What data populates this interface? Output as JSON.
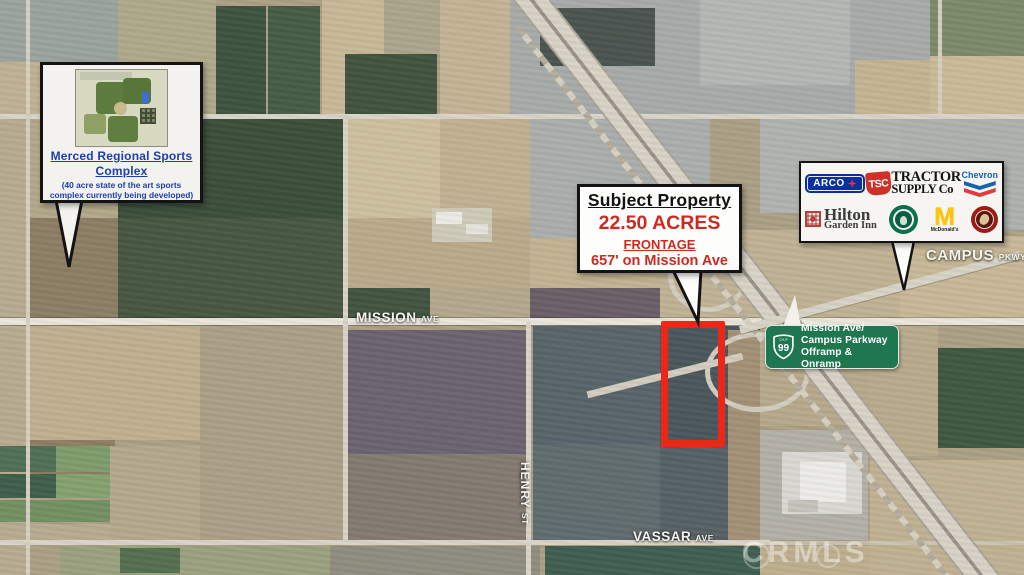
{
  "streets": {
    "mission_name": "MISSION",
    "mission_type": "AVE",
    "campus_name": "CAMPUS",
    "campus_type": "PKWY",
    "henry_name": "HENRY",
    "henry_type": "ST",
    "vassar_name": "VASSAR",
    "vassar_type": "AVE"
  },
  "watermark": "CRMLS",
  "sports_callout": {
    "title1": "Merced Regional Sports",
    "title2": "Complex",
    "sub1": "(40 acre state of the art sports",
    "sub2": "complex currently being developed)"
  },
  "subject_callout": {
    "title": "Subject Property",
    "acres": "22.50 ACRES",
    "frontage": "FRONTAGE",
    "frontage_detail": "657' on Mission Ave"
  },
  "freeway_sign": {
    "route": "99",
    "state": "CALIF",
    "line1": "Mission Ave/",
    "line2": "Campus Parkway",
    "line3": "Offramp & Onramp"
  },
  "brands": {
    "arco": "ARCO",
    "tsc": "TSC",
    "tractor1": "TRACTOR",
    "tractor2": "SUPPLY Co",
    "chevron": "Chevron",
    "hilton1": "Hilton",
    "hilton2": "Garden Inn",
    "mcdonalds": "McDonald's"
  },
  "colors": {
    "subject_outline": "#ee2617",
    "sign_green": "#1f7750",
    "callout_blue": "#1b3fae",
    "accent_red": "#cc2a20",
    "arco_blue": "#0a2f9e",
    "tsc_red": "#cc3227",
    "chevron_blue": "#1464ae",
    "chevron_red": "#e13a3c",
    "starbucks_green": "#0e6f4e",
    "mcdonalds_yellow": "#fdc50c",
    "chipotle_maroon": "#9c1b15",
    "hilton_red": "#b5403e"
  }
}
